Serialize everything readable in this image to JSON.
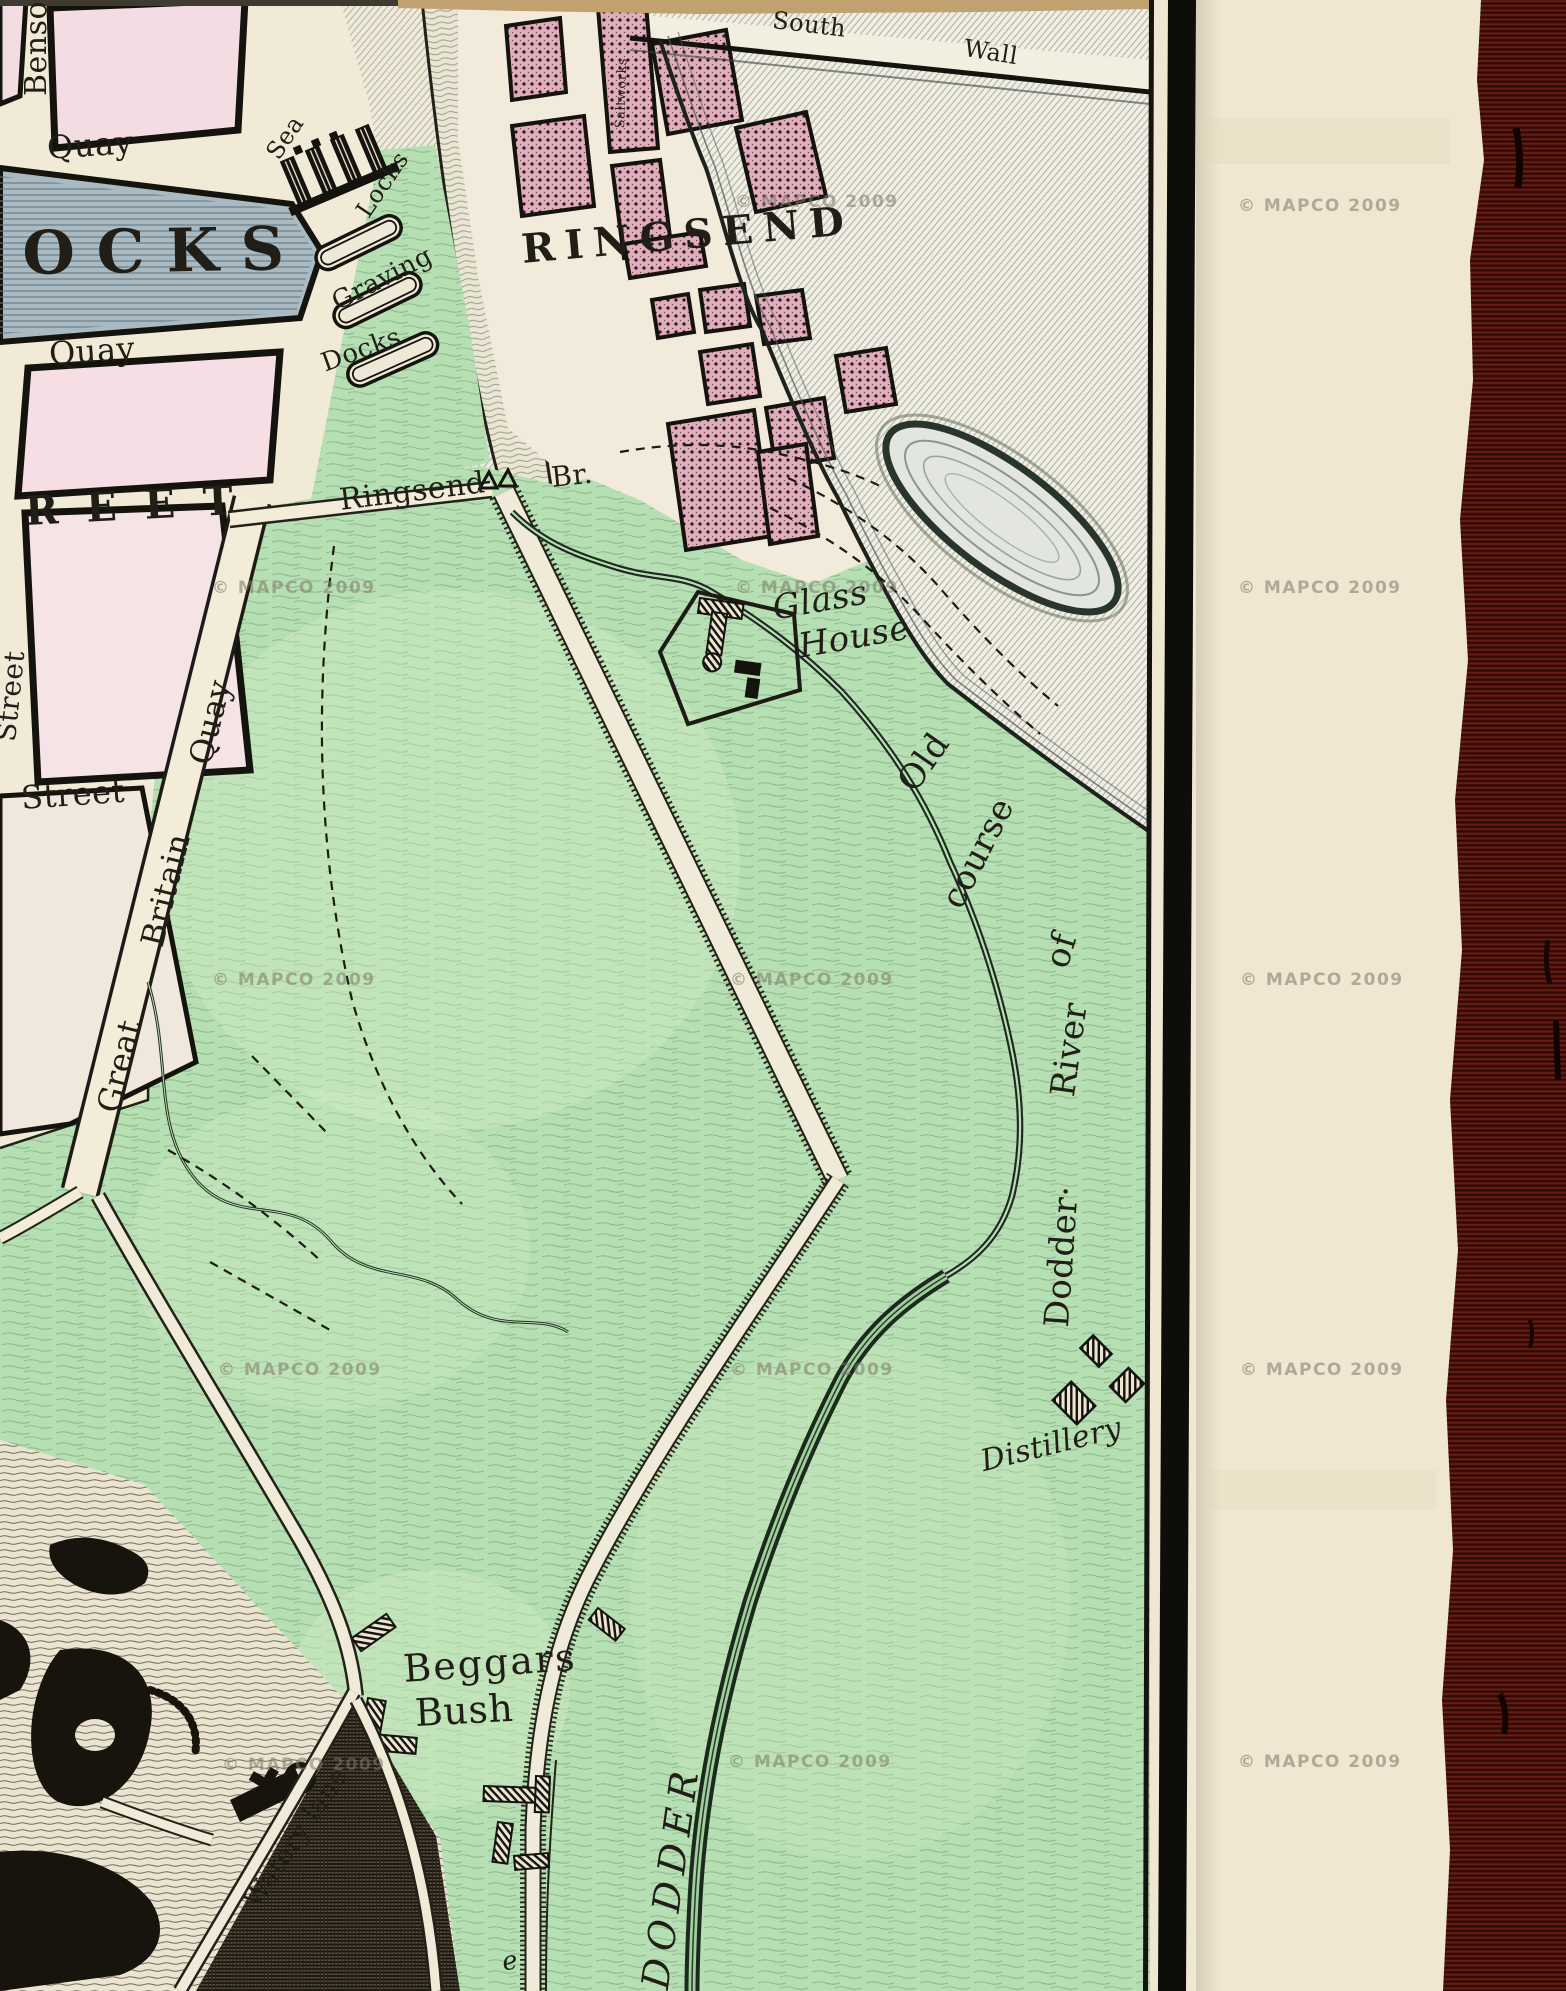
{
  "map": {
    "labels": {
      "benson": "Benson",
      "quay_north": "Quay",
      "ocks": "OCKS",
      "sea": "Sea",
      "locks": "Locks",
      "graving": "Graving",
      "docks": "Docks",
      "quay_south": "Quay",
      "reet": "REET",
      "street_vertical": "Street",
      "street_lower": "Street",
      "great": "Great",
      "britain": "Britain",
      "gb_quay": "Quay",
      "saltworks": "Saltworks",
      "ringsend": "RINGSEND",
      "south": "South",
      "wall": "Wall",
      "ringsend_road": "Ringsend",
      "bridge": "Br.",
      "glass": "Glass",
      "house": "House",
      "old": "Old",
      "course": "course",
      "of": "of",
      "river": "River",
      "dodder_old": "Dodder·",
      "distillery": "Distillery",
      "beggars": "Beggars",
      "bush": "Bush",
      "watery_lane": "Watery lane",
      "dodder": "DODDER",
      "e_fragment": "e"
    },
    "watermark": "© MAPCO 2009"
  }
}
